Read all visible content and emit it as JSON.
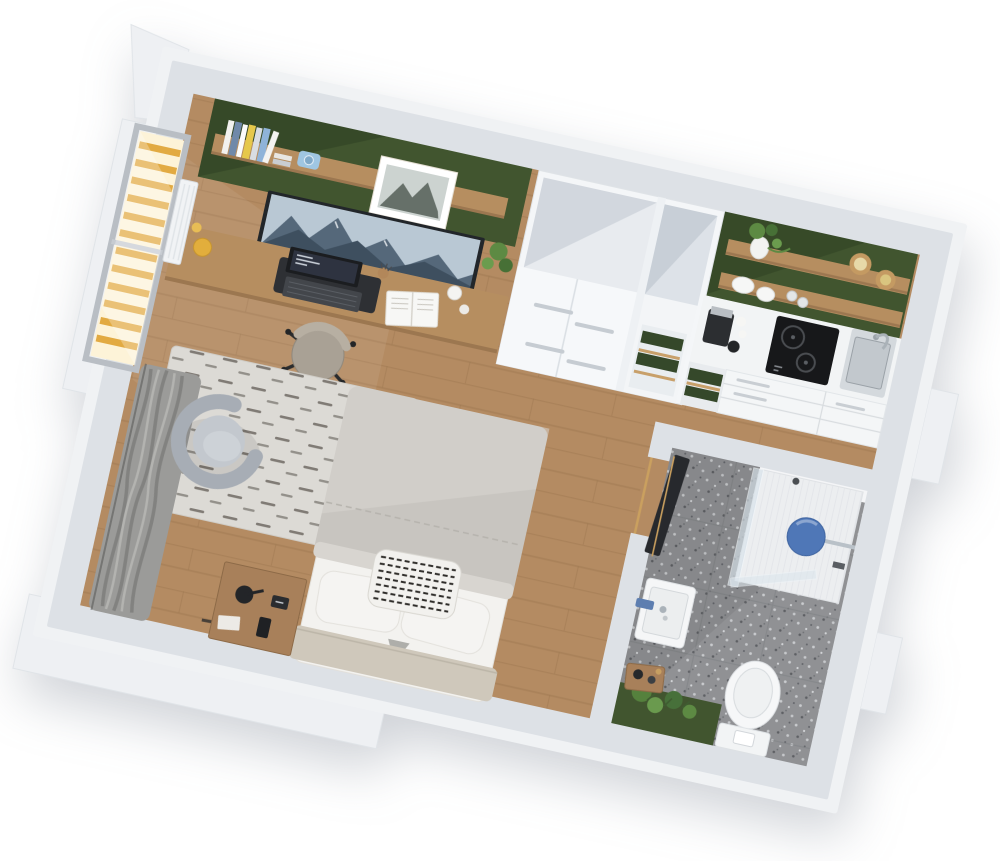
{
  "scene": {
    "description": "3D cutaway top-down render of a studio apartment floor plan on a white background",
    "view": "axonometric, plan rotated about 12 degrees clockwise",
    "render_style": "photorealistic architectural visualization"
  },
  "palette": {
    "background": "#ffffff",
    "wall_outer": "#f0f2f4",
    "wall_top": "#dde1e6",
    "accent_green": "#41552f",
    "accent_green_shadow": "#2c3d21",
    "shelf_green": "#35482a",
    "wood_floor": "#b48b62",
    "wood_furniture": "#b68e60",
    "wood_dark": "#8d6a47",
    "rug": "#dcdad5",
    "duvet": "#c8c5c0",
    "linen_white": "#f3f2ef",
    "headboard": "#cfc8bb",
    "armchair": "#a7adb5",
    "armchair_seat": "#c3c8ce",
    "curtain": "#9b9b99",
    "window_light": "#fdf3d8",
    "window_slat": "#e2aa42",
    "terrazzo": "#909194",
    "shower_blue": "#4f77b7",
    "tv_dark": "#22262a",
    "door_dark": "#27292d",
    "door_frame_wood": "#c79f62",
    "cooktop_black": "#17181a",
    "steel": "#d4d9dd",
    "plant_green": "#5d8a43",
    "camera_blue": "#9fc6e2",
    "cork": "#c49a62",
    "book_yellow": "#e6c84b",
    "book_blue": "#7089a9"
  },
  "rooms": [
    {
      "id": "living-sleeping-area",
      "floor": "oak wood planks",
      "accent_wall": "dark green",
      "items": [
        "wall shelf with books",
        "instant camera",
        "framed mountain photo",
        "wall tv with mountain scene",
        "potted plant",
        "wood desk with laptop, notebook, mug, yellow bowl",
        "office chair",
        "white wardrobe with open top",
        "shaggy striped rug",
        "double bed with grey duvet, white pillows, striped pillow",
        "wood nightstand with lamp, clock, phone",
        "grey tub armchair",
        "grey curtains",
        "window with warm wooden blinds",
        "radiator"
      ]
    },
    {
      "id": "kitchenette",
      "floor": "oak wood planks",
      "accent_wall": "dark green",
      "items": [
        "two wood open shelves",
        "potted plant",
        "cork-lid pantry jars",
        "plate stacks",
        "glasses",
        "coffee machine",
        "two-ring induction cooktop",
        "steel sink with faucet",
        "white drawer cabinets",
        "appliance nook with green shelves"
      ]
    },
    {
      "id": "bathroom",
      "floor": "grey terrazzo tiles",
      "accent_wall": "dark green",
      "items": [
        "walk-in shower with glass screen",
        "blue round rain shower head",
        "wall-hung white sink with blue faucet",
        "wall-hung toilet with flush plate",
        "green plants",
        "wood tray with candles",
        "dark sliding door with brass frame"
      ]
    },
    {
      "id": "balcony",
      "floor": "white deck",
      "items": []
    }
  ]
}
